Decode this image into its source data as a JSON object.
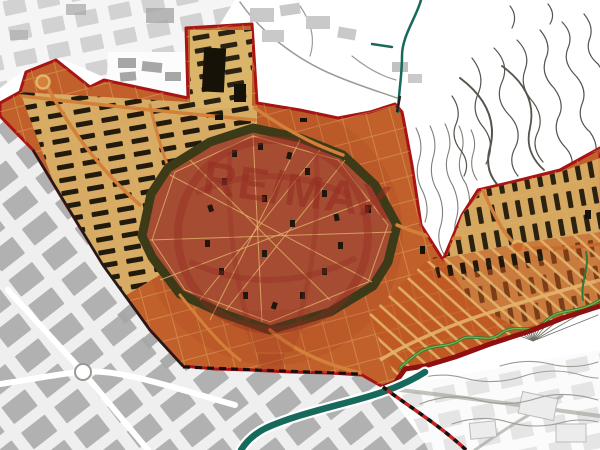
{
  "watermark": {
    "text": "RE/MAX"
  },
  "map": {
    "colors": {
      "background": "#ffffff",
      "zone_fill": "#c2602b",
      "zone_border": "#a81414",
      "zone_border_heavy": "#8e1010",
      "block_tan": "#d9b469",
      "building_black": "#171208",
      "street_khaki": "#e2b46a",
      "street_orange": "#d2803a",
      "fortress_ring": "#3d3a18",
      "fortress_inner": "#a64c33",
      "water_teal": "#17695c",
      "stream_green_dark": "#2f7a36",
      "stream_green_light": "#7ab648",
      "road_red": "#c32222",
      "city_gray": "#a6a6a6",
      "city_gray_light": "#c9c9c9",
      "city_bg": "#efefef",
      "contour_dark": "#55554e",
      "contour_light": "#9c9c94",
      "watermark_red": "#932a21"
    }
  }
}
